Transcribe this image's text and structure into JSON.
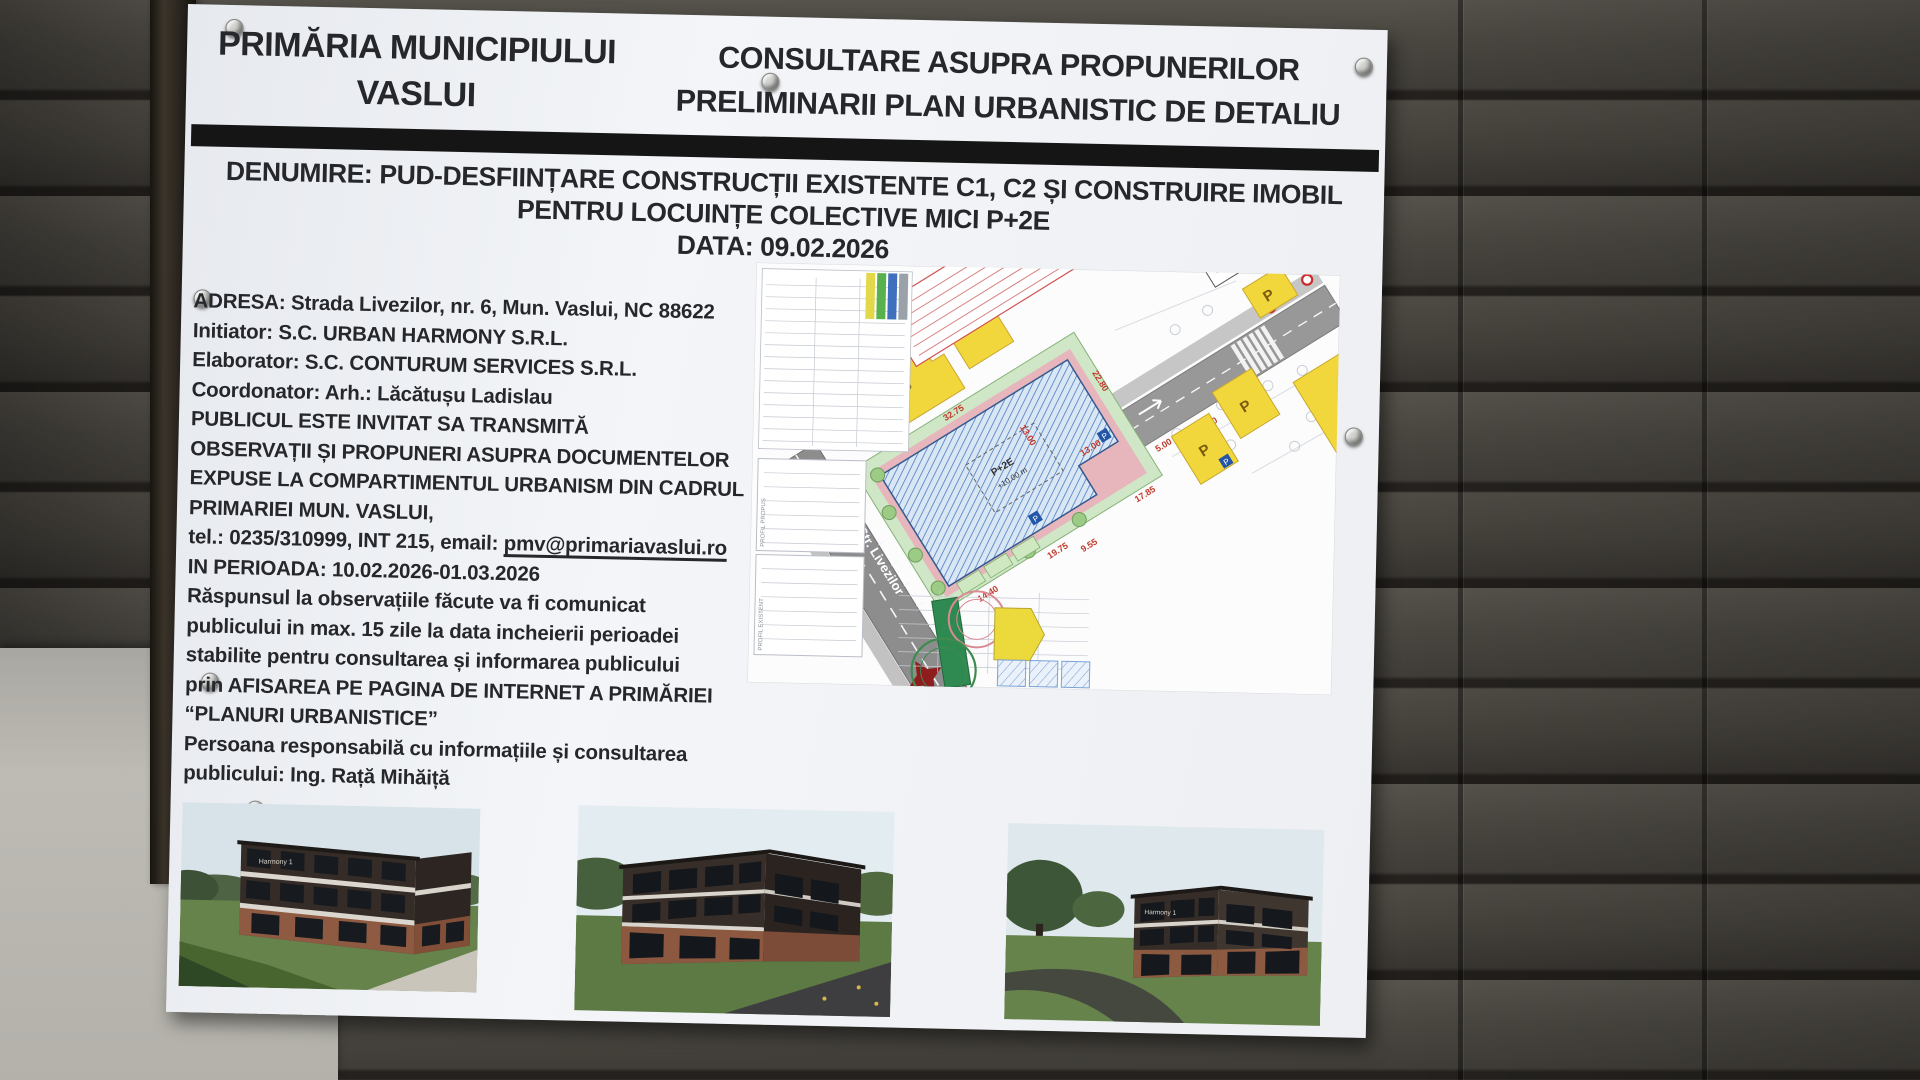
{
  "board": {
    "header": {
      "left_line1": "PRIMĂRIA MUNICIPIULUI",
      "left_line2": "VASLUI",
      "right_line1": "CONSULTARE ASUPRA PROPUNERILOR",
      "right_line2": "PRELIMINARII PLAN URBANISTIC DE DETALIU"
    },
    "title": {
      "line1": "DENUMIRE: PUD-DESFIINȚARE CONSTRUCȚII EXISTENTE C1, C2 ȘI CONSTRUIRE IMOBIL",
      "line2": "PENTRU LOCUINȚE COLECTIVE MICI P+2E",
      "date_line": "DATA: 09.02.2026"
    },
    "info": {
      "address": "ADRESA: Strada Livezilor, nr. 6, Mun. Vaslui, NC 88622",
      "initiator": "Initiator: S.C. URBAN HARMONY S.R.L.",
      "elaborator": "Elaborator: S.C. CONTURUM SERVICES S.R.L.",
      "coordinator": "Coordonator: Arh.: Lăcătușu Ladislau",
      "para1": [
        "PUBLICUL ESTE INVITAT SA TRANSMITĂ",
        "OBSERVAȚII ȘI PROPUNERI ASUPRA DOCUMENTELOR",
        "EXPUSE LA COMPARTIMENTUL  URBANISM DIN CADRUL",
        "PRIMARIEI MUN. VASLUI,"
      ],
      "contact_prefix": "tel.: 0235/310999, INT 215, email: ",
      "email": "pmv@primariavaslui.ro",
      "period": "IN PERIOADA: 10.02.2026-01.03.2026",
      "para2": [
        "Răspunsul la observațiile făcute va fi comunicat",
        "publicului in max. 15 zile la data incheierii perioadei",
        "stabilite pentru consultarea și informarea publicului",
        "prin AFISAREA PE PAGINA DE INTERNET A PRIMĂRIEI",
        "“PLANURI URBANISTICE”"
      ],
      "para3": [
        "Persoana responsabilă cu informațiile și consultarea",
        "publicului: Ing. Rață Mihăiță"
      ]
    },
    "site_plan": {
      "street_label": "Str. Livezilor",
      "building_mark": "P",
      "core_label_floors": "P+2E",
      "core_label_height": "+10.00 m",
      "edge_note": "HC / 5149 - CRETU VIOLETA",
      "profile_label_1": "PROFIL PROPUS",
      "profile_label_2": "PROFIL EXISTENT",
      "utr": {
        "r1c1": "35.00 %",
        "r1c2": "1.2",
        "r2c1": "+10.00 m",
        "r2c2": "P+2E",
        "title": "UTR 3 - Lc"
      },
      "dims": [
        "32.75",
        "22.80",
        "14.40",
        "19.75",
        "13.00",
        "13.00",
        "17.85",
        "5.00",
        "3.00",
        "9.55"
      ]
    },
    "renders": {
      "facade_sign": "Harmony 1"
    },
    "colors": {
      "board_bg": "#f0f2f6",
      "bar": "#151515",
      "text": "#26272b",
      "plan_yellow": "#f1d73b",
      "plan_hatch_blue": "#4b7cc1",
      "plan_pink": "#e7b6bd",
      "plan_green": "#cfe7c6",
      "plan_road": "#8d8d8d",
      "stamp_green": "#3f8a4f",
      "stamp_red": "#d98a93"
    }
  }
}
